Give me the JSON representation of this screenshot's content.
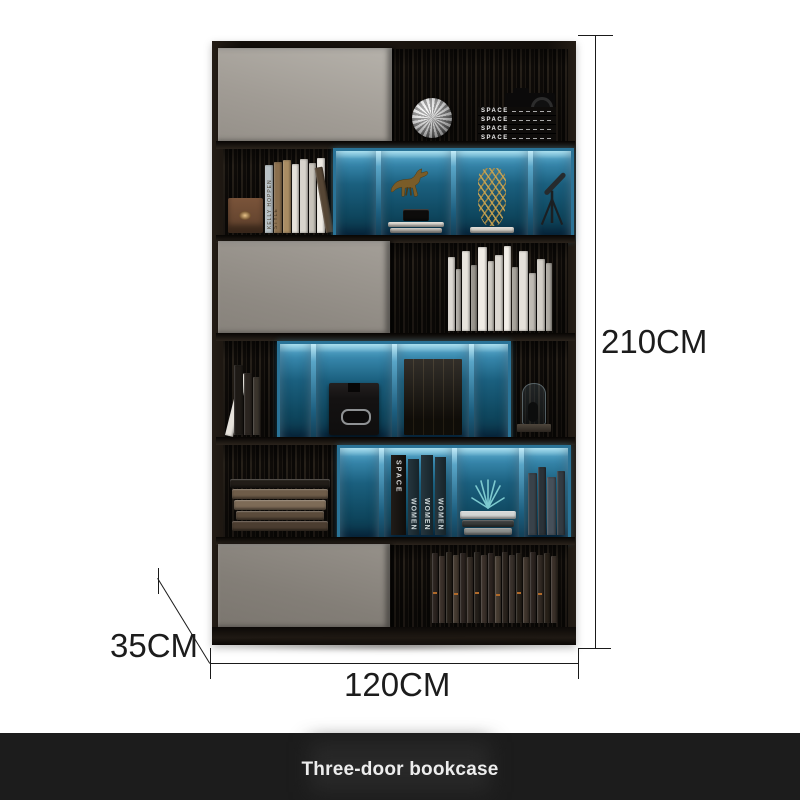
{
  "page": {
    "background": "#ffffff"
  },
  "product": {
    "title": "Three-door bookcase",
    "dimensions": {
      "height": "210CM",
      "width": "120CM",
      "depth": "35CM"
    },
    "colors": {
      "accent_blue": "#2f85ad",
      "frame_black": "#1a140f",
      "door_gray": "#a39e97",
      "dimension_line": "#1a1a1a",
      "caption_bar": "#1c1c1c",
      "caption_text": "#ededed"
    }
  },
  "decor_labels": {
    "space_stack": "SPACE",
    "space_book": "SPACE",
    "women_book": "WOMEN",
    "kelly_book": "KELLY HOPPEN STYLE"
  },
  "shelves": {
    "row2_lean_books": [
      {
        "w": 8,
        "h": 68,
        "c": "#b9c2c6"
      },
      {
        "w": 8,
        "h": 71,
        "c": "#8a6f4e"
      },
      {
        "w": 8,
        "h": 73,
        "c": "#a98c63"
      },
      {
        "w": 7,
        "h": 69,
        "c": "#e6e2db"
      },
      {
        "w": 8,
        "h": 74,
        "c": "#d8d4cc"
      },
      {
        "w": 7,
        "h": 70,
        "c": "#c7c2b9"
      },
      {
        "w": 8,
        "h": 75,
        "c": "#eeeae3"
      },
      {
        "w": 8,
        "h": 66,
        "c": "#564635",
        "lean": -10
      }
    ],
    "row3_books": [
      {
        "w": 7,
        "h": 74,
        "c": "#ddd9d2"
      },
      {
        "w": 5,
        "h": 62,
        "c": "#b0aca4"
      },
      {
        "w": 8,
        "h": 80,
        "c": "#e8e4dd"
      },
      {
        "w": 6,
        "h": 66,
        "c": "#98948c"
      },
      {
        "w": 9,
        "h": 84,
        "c": "#f0ece5"
      },
      {
        "w": 6,
        "h": 70,
        "c": "#cdc9c1"
      },
      {
        "w": 8,
        "h": 76,
        "c": "#dcd8d1"
      },
      {
        "w": 7,
        "h": 85,
        "c": "#f3efe8"
      },
      {
        "w": 6,
        "h": 64,
        "c": "#a7a39b"
      },
      {
        "w": 9,
        "h": 80,
        "c": "#e5e1da"
      },
      {
        "w": 7,
        "h": 58,
        "c": "#bfbbb3"
      },
      {
        "w": 8,
        "h": 72,
        "c": "#d3cfc7"
      },
      {
        "w": 6,
        "h": 68,
        "c": "#aeaaa2"
      }
    ],
    "row4_lean_books": [
      {
        "w": 8,
        "h": 64,
        "c": "#e7e3dc",
        "lean": 14
      },
      {
        "w": 9,
        "h": 70,
        "c": "#1e1a16"
      },
      {
        "w": 8,
        "h": 62,
        "c": "#2b2520"
      },
      {
        "w": 7,
        "h": 58,
        "c": "#3a342d"
      }
    ],
    "row5_left_stack": [
      {
        "w": 100,
        "h": 9,
        "c": "#221d18"
      },
      {
        "w": 96,
        "h": 10,
        "c": "#6e5c49"
      },
      {
        "w": 92,
        "h": 10,
        "c": "#7d6b57"
      },
      {
        "w": 88,
        "h": 9,
        "c": "#5b4b3b"
      },
      {
        "w": 96,
        "h": 10,
        "c": "#4b3d30"
      }
    ],
    "row5_plant_stack": [
      {
        "w": 56,
        "h": 8,
        "c": "#d3d6d5"
      },
      {
        "w": 52,
        "h": 7,
        "c": "#3a3d3c"
      },
      {
        "w": 48,
        "h": 7,
        "c": "#8d908e"
      }
    ],
    "row5_right_books": [
      {
        "w": 9,
        "h": 62,
        "c": "#39424a"
      },
      {
        "w": 8,
        "h": 68,
        "c": "#2a3238"
      },
      {
        "w": 9,
        "h": 58,
        "c": "#46505a"
      },
      {
        "w": 8,
        "h": 64,
        "c": "#333b42"
      }
    ],
    "horse_base_stack": [
      {
        "w": 26,
        "h": 12,
        "c": "#0d0c0b"
      },
      {
        "w": 56,
        "h": 5,
        "c": "#dbd7d0"
      },
      {
        "w": 52,
        "h": 5,
        "c": "#b9b5ae"
      }
    ],
    "vase_book_stack": [
      {
        "w": 44,
        "h": 6,
        "c": "#d8d4cc"
      }
    ],
    "row6_books": [
      {
        "w": 6,
        "h": 70,
        "c": "#2c2420",
        "a": "#b06a2a"
      },
      {
        "w": 6,
        "h": 67,
        "c": "#3b312a"
      },
      {
        "w": 6,
        "h": 71,
        "c": "#262019"
      },
      {
        "w": 6,
        "h": 68,
        "c": "#443a30",
        "a": "#b06a2a"
      },
      {
        "w": 6,
        "h": 70,
        "c": "#2c2420"
      },
      {
        "w": 6,
        "h": 66,
        "c": "#352c25"
      },
      {
        "w": 6,
        "h": 71,
        "c": "#241f1a",
        "a": "#b06a2a"
      },
      {
        "w": 6,
        "h": 68,
        "c": "#3b312a"
      },
      {
        "w": 6,
        "h": 70,
        "c": "#2c2420"
      },
      {
        "w": 6,
        "h": 67,
        "c": "#453b31",
        "a": "#b06a2a"
      },
      {
        "w": 6,
        "h": 71,
        "c": "#2a231d"
      },
      {
        "w": 6,
        "h": 68,
        "c": "#38302a"
      },
      {
        "w": 6,
        "h": 70,
        "c": "#262019",
        "a": "#b06a2a"
      },
      {
        "w": 6,
        "h": 66,
        "c": "#3f352c"
      },
      {
        "w": 6,
        "h": 71,
        "c": "#2c2420"
      },
      {
        "w": 6,
        "h": 68,
        "c": "#332b24",
        "a": "#b06a2a"
      },
      {
        "w": 6,
        "h": 70,
        "c": "#282119"
      },
      {
        "w": 6,
        "h": 67,
        "c": "#3a3029"
      }
    ]
  }
}
